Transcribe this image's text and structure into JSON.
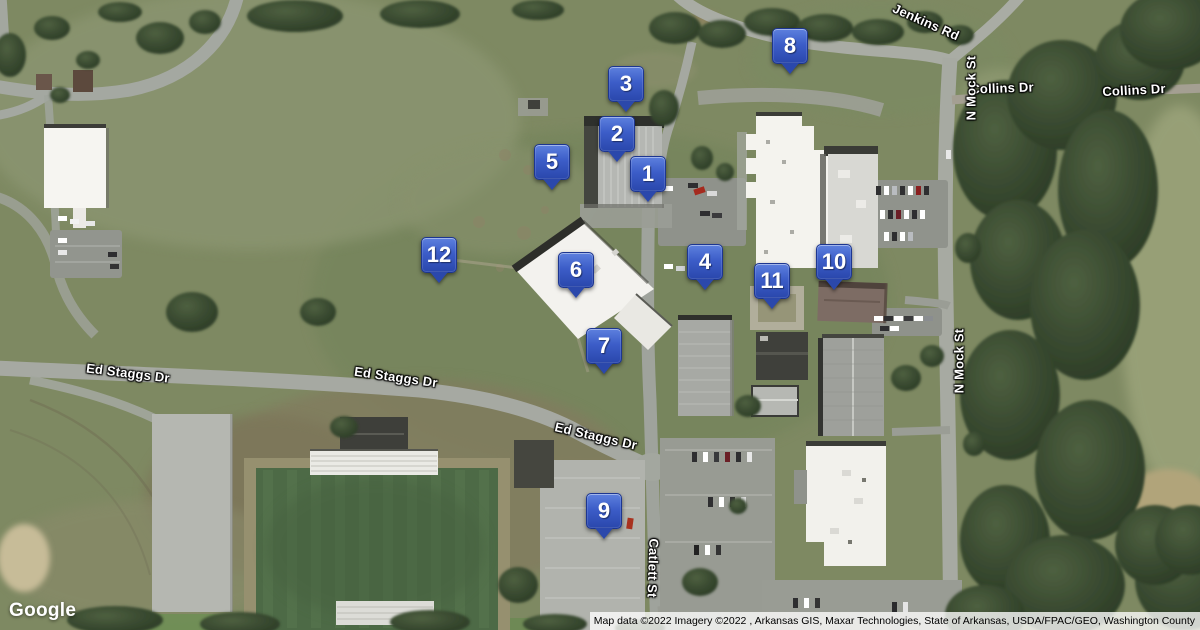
{
  "map": {
    "markers": [
      {
        "number": "1",
        "x": 648,
        "y": 174
      },
      {
        "number": "2",
        "x": 617,
        "y": 134
      },
      {
        "number": "3",
        "x": 626,
        "y": 84
      },
      {
        "number": "4",
        "x": 705,
        "y": 262
      },
      {
        "number": "5",
        "x": 552,
        "y": 162
      },
      {
        "number": "6",
        "x": 576,
        "y": 270
      },
      {
        "number": "7",
        "x": 604,
        "y": 346
      },
      {
        "number": "8",
        "x": 790,
        "y": 46
      },
      {
        "number": "9",
        "x": 604,
        "y": 511
      },
      {
        "number": "10",
        "x": 834,
        "y": 262
      },
      {
        "number": "11",
        "x": 772,
        "y": 281
      },
      {
        "number": "12",
        "x": 439,
        "y": 255
      }
    ],
    "road_labels": [
      {
        "text": "Jenkins Rd",
        "x": 926,
        "y": 22,
        "rotate": 24
      },
      {
        "text": "Collins Dr",
        "x": 1002,
        "y": 88,
        "rotate": -2
      },
      {
        "text": "Collins Dr",
        "x": 1134,
        "y": 90,
        "rotate": -3
      },
      {
        "text": "N Mock St",
        "x": 971,
        "y": 88,
        "rotate": -90
      },
      {
        "text": "N Mock St",
        "x": 959,
        "y": 361,
        "rotate": -90
      },
      {
        "text": "Ed Staggs Dr",
        "x": 128,
        "y": 373,
        "rotate": 7
      },
      {
        "text": "Ed Staggs Dr",
        "x": 396,
        "y": 377,
        "rotate": 8
      },
      {
        "text": "Ed Staggs Dr",
        "x": 596,
        "y": 436,
        "rotate": 13
      },
      {
        "text": "Catlett St",
        "x": 653,
        "y": 568,
        "rotate": 92
      }
    ],
    "marker_style": {
      "fill_top": "#5d80de",
      "fill_bottom": "#2a47ac",
      "border": "#1d3690",
      "text_color": "#ffffff"
    }
  },
  "footer": {
    "logo": "Google",
    "attribution": "Map data ©2022 Imagery ©2022 , Arkansas GIS, Maxar Technologies, State of Arkansas, USDA/FPAC/GEO, Washington County"
  }
}
